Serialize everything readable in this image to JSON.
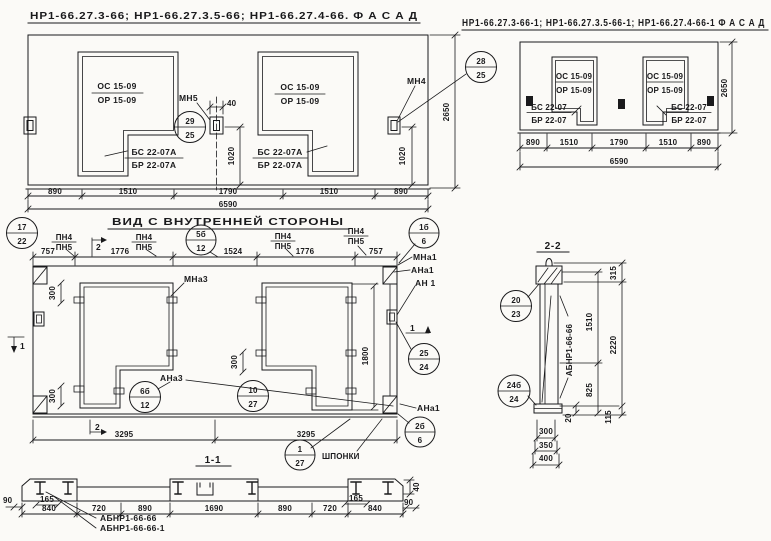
{
  "colors": {
    "ink": "#1a1a1c",
    "paper": "#fbfaf7"
  },
  "titles": {
    "facade_left": "НР1-66.27.3-66; НР1-66.27.3.5-66; НР1-66.27.4-66.  Ф А С А Д",
    "facade_right": "НР1-66.27.3-66-1; НР1-66.27.3.5-66-1; НР1-66.27.4-66-1  Ф А С А Д",
    "inner_view": "ВИД С ВНУТРЕННЕЙ СТОРОНЫ",
    "section_1_1": "1-1",
    "section_2_2": "2-2"
  },
  "facade1": {
    "openings": {
      "top": "ОС 15-09",
      "bottom": "ОР 15-09"
    },
    "sills": {
      "top": "БС 22-07А",
      "bottom": "БР 22-07А"
    },
    "anchor_mid": "МН5",
    "anchor_right": "МН4",
    "dims_bottom": [
      "890",
      "1510",
      "1790",
      "1510",
      "890"
    ],
    "dim_total": "6590",
    "dim_height": "2650",
    "dim_anchor_offset": "40",
    "dim_anchor_height": "1020",
    "callout_mid": {
      "top": "29",
      "bottom": "25"
    },
    "callout_right": {
      "top": "28",
      "bottom": "25"
    }
  },
  "facade2": {
    "openings": {
      "top": "ОС 15-09",
      "bottom": "ОР 15-09"
    },
    "sills": {
      "top": "БС 22-07",
      "bottom": "БР 22-07"
    },
    "dims_bottom": [
      "890",
      "1510",
      "1790",
      "1510",
      "890"
    ],
    "dim_total": "6590",
    "dim_height": "2650"
  },
  "inner": {
    "dims_top": [
      "757",
      "1776",
      "1524",
      "1776",
      "757"
    ],
    "partition_label": {
      "top": "ПН4",
      "bottom": "ПН5"
    },
    "labels": {
      "mna3": "МНа3",
      "ana3": "АНа3",
      "mna1": "МНа1",
      "ana1": "АНа1",
      "an1": "АН 1",
      "ana1_b": "АНа1",
      "shponki": "ШПОНКИ"
    },
    "dims": {
      "edge300": "300",
      "height1800": "1800",
      "half": "3295"
    },
    "callouts": {
      "top_left": {
        "top": "17",
        "bottom": "22"
      },
      "top_mid": {
        "top": "5б",
        "bottom": "12"
      },
      "top_right": {
        "top": "1б",
        "bottom": "6"
      },
      "opening_left": {
        "top": "6б",
        "bottom": "12"
      },
      "bottom_mid": {
        "top": "10",
        "bottom": "27"
      },
      "right": {
        "top": "25",
        "bottom": "24"
      },
      "bottom_right": {
        "top": "2б",
        "bottom": "6"
      },
      "keys": {
        "top": "1",
        "bottom": "27"
      }
    },
    "section_marks": {
      "s1": "1",
      "s2": "2"
    }
  },
  "section11": {
    "dims": [
      "840",
      "720",
      "890",
      "1690",
      "890",
      "720",
      "840"
    ],
    "dim_90_left": "90",
    "dim_90_right": "90",
    "dim_165_left": "165",
    "dim_165_right": "165",
    "dim_40": "40",
    "labels": [
      "АБНР1-66-66",
      "АБНР1-66-66-1"
    ]
  },
  "section22": {
    "body_label": "АБНР1-66-66",
    "dims": {
      "d315": "315",
      "d1510": "1510",
      "d2220": "2220",
      "d825": "825",
      "d20": "20",
      "d115": "115",
      "d300": "300",
      "d350": "350",
      "d400": "400"
    },
    "callout_top": {
      "top": "20",
      "bottom": "23"
    },
    "callout_bottom": {
      "top": "24б",
      "bottom": "24"
    }
  }
}
